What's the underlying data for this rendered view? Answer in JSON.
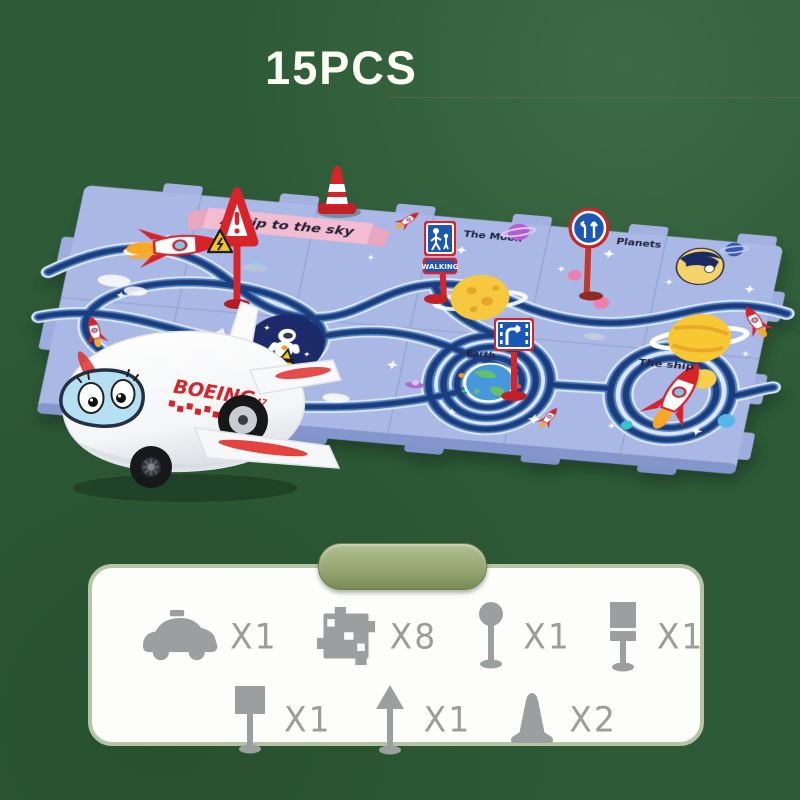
{
  "header": {
    "pieces_badge": "15PCS"
  },
  "mat": {
    "banner_text": "A trip to the sky",
    "area_labels": {
      "moon": "The Moon",
      "planets": "Planets",
      "earth": "Earth",
      "ship": "The ship",
      "astronaut": "Astronaut"
    },
    "walking_sign_text": "WALKING",
    "colors": {
      "mat_base": "#a9b8e4",
      "track_navy": "#1d3d7c",
      "track_blue": "#4d7fc7",
      "track_pale": "#dfe9f8",
      "sign_blue": "#1b57b5",
      "accent_red": "#d8232a"
    }
  },
  "plane": {
    "brand_text": "BOEING",
    "model_text": "747"
  },
  "parts_panel": {
    "items": [
      {
        "name": "toy car",
        "qty": "X1"
      },
      {
        "name": "track tile",
        "qty": "X8"
      },
      {
        "name": "round sign",
        "qty": "X1"
      },
      {
        "name": "walking signpost",
        "qty": "X1"
      },
      {
        "name": "square sign",
        "qty": "X1"
      },
      {
        "name": "arrow sign",
        "qty": "X1"
      },
      {
        "name": "traffic cone",
        "qty": "X2"
      }
    ]
  },
  "background": {
    "color": "#2e5b37",
    "panel_tab_color": "#96a774"
  }
}
